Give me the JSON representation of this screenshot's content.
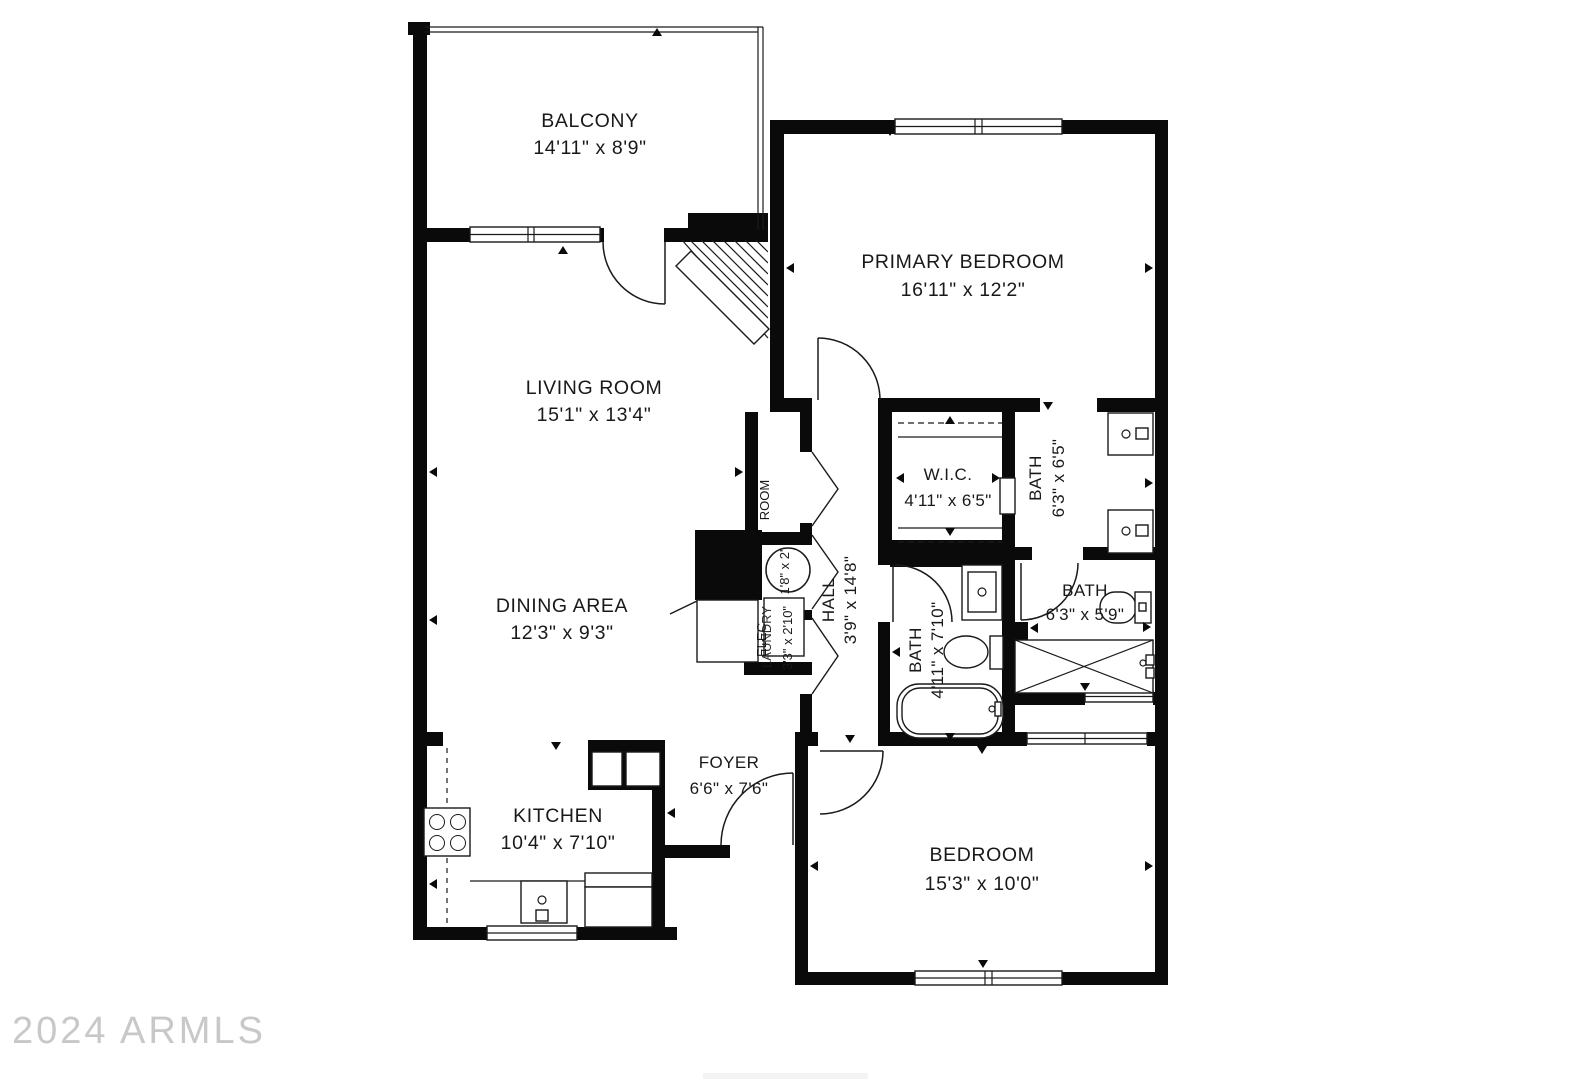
{
  "watermark": {
    "text": "2024 ARMLS"
  },
  "colors": {
    "wall": "#0a0a0a",
    "line": "#1a1a1a",
    "text": "#191919",
    "watermark": "#c8c8c8",
    "background": "#ffffff"
  },
  "rooms": {
    "balcony": {
      "name": "BALCONY",
      "dims": "14'11\" x 8'9\""
    },
    "primary_bedroom": {
      "name": "PRIMARY BEDROOM",
      "dims": "16'11\" x 12'2\""
    },
    "living_room": {
      "name": "LIVING ROOM",
      "dims": "15'1\" x 13'4\""
    },
    "dining_area": {
      "name": "DINING AREA",
      "dims": "12'3\" x 9'3\""
    },
    "wic": {
      "name": "W.I.C.",
      "dims": "4'11\" x 6'5\""
    },
    "primary_bath": {
      "name": "BATH",
      "dims": "6'3\" x 6'5\""
    },
    "hall": {
      "name": "HALL",
      "dims": "3'9\" x 14'8\""
    },
    "hall_bath": {
      "name": "BATH",
      "dims": "4'11\" x 7'10\""
    },
    "shower_bath": {
      "name": "BATH",
      "dims": "6'3\" x 5'9\""
    },
    "foyer": {
      "name": "FOYER",
      "dims": "6'6\" x 7'6\""
    },
    "kitchen": {
      "name": "KITCHEN",
      "dims": "10'4\" x 7'10\""
    },
    "bedroom": {
      "name": "BEDROOM",
      "dims": "15'3\" x 10'0\""
    },
    "storage": {
      "name": "ROOM",
      "dims": "1'8\" x 2'"
    },
    "laundry": {
      "name": "LAUNDRY",
      "dims": "3'3\" x 2'10\""
    },
    "elec": {
      "name": "ELEC"
    }
  }
}
